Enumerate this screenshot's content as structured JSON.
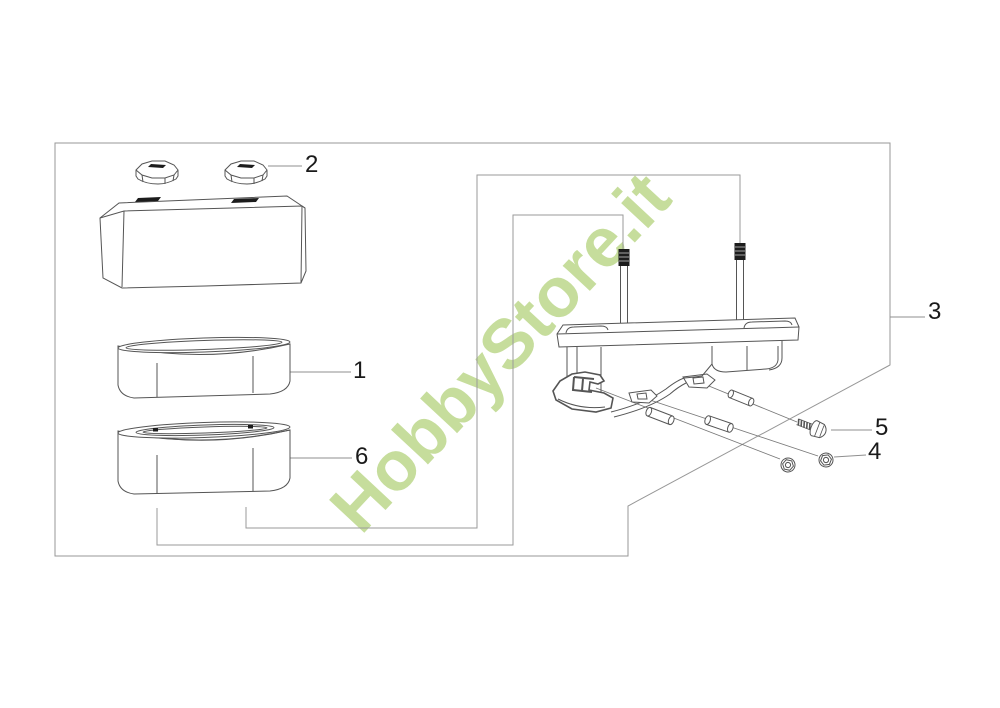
{
  "watermark": {
    "text": "HobbyStore.it",
    "color": "#c6dd9c"
  },
  "callouts": {
    "c1": {
      "label": "1"
    },
    "c2": {
      "label": "2"
    },
    "c3": {
      "label": "3"
    },
    "c4": {
      "label": "4"
    },
    "c5": {
      "label": "5"
    },
    "c6": {
      "label": "6"
    }
  },
  "colors": {
    "background": "#ffffff",
    "part_line": "#555555",
    "guide_line": "#979797",
    "dark_fill": "#1c1c1c",
    "label_text": "#1a1a1a",
    "watermark_green": "#c6dd9c"
  }
}
